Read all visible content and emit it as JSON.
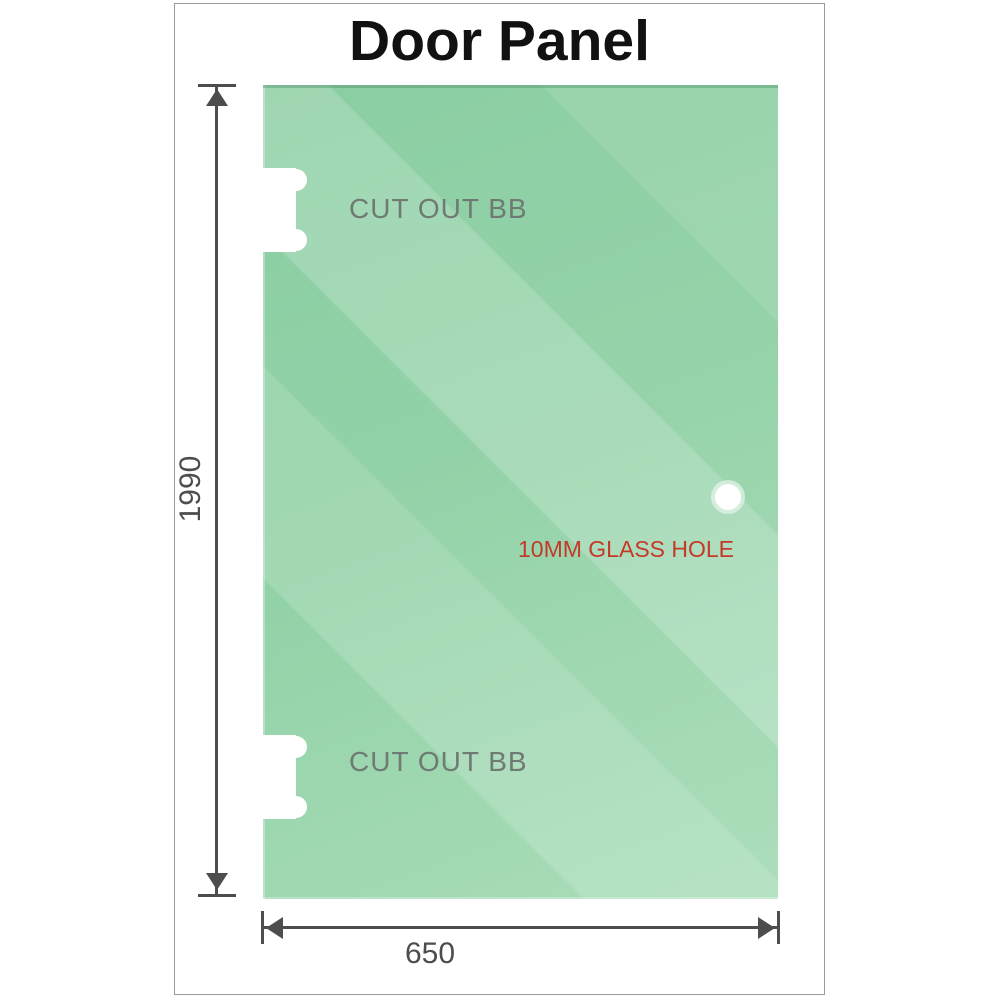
{
  "title": "Door Panel",
  "panel": {
    "cutouts": [
      {
        "label": "CUT OUT BB"
      },
      {
        "label": "CUT OUT BB"
      }
    ],
    "hole": {
      "label": "10MM GLASS HOLE"
    }
  },
  "dimensions": {
    "height": {
      "value": "1990"
    },
    "width": {
      "value": "650"
    }
  },
  "colors": {
    "glass_green": "#8fd0a5",
    "glass_green_dark": "#84cb9d",
    "glass_green_light": "#a9ddb9",
    "dimension_grey": "#4d4d4d",
    "cutout_label_grey": "#6f7a73",
    "hole_label_red": "#c43a29",
    "frame_border": "#9a9a9a",
    "title_black": "#111111"
  }
}
